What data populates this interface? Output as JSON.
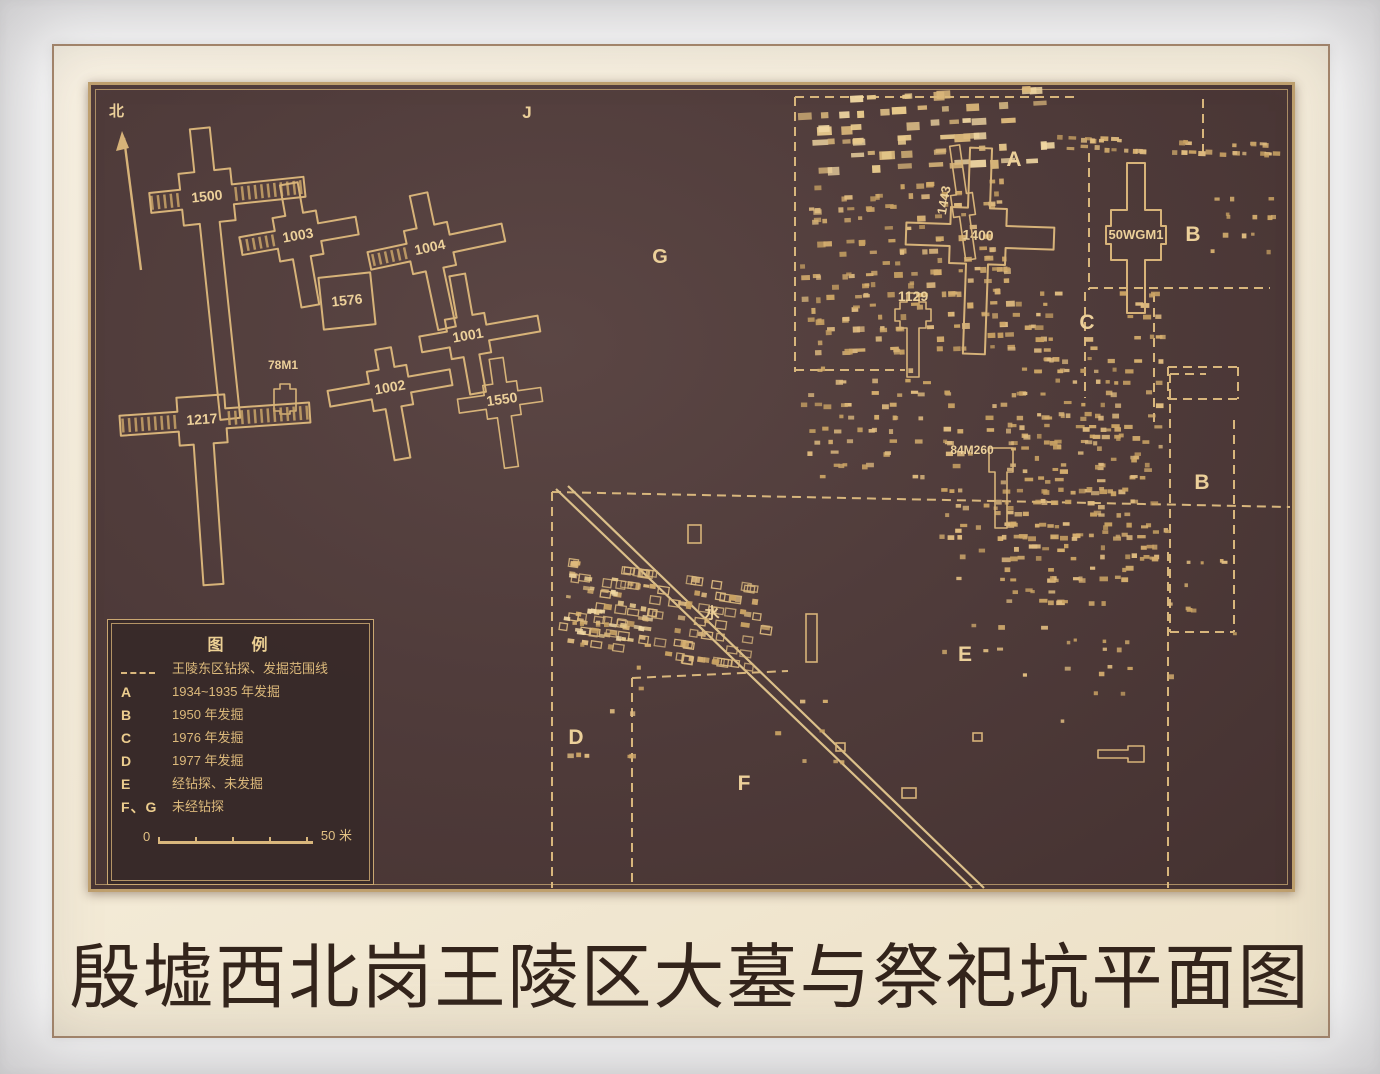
{
  "caption": "殷墟西北岗王陵区大墓与祭祀坑平面图",
  "compass": {
    "label": "北"
  },
  "legend": {
    "title": "图　例",
    "items": [
      {
        "symbol": "dash-line",
        "label": "王陵东区钻探、发掘范围线"
      },
      {
        "symbol": "A",
        "label": "1934~1935 年发掘"
      },
      {
        "symbol": "B",
        "label": "1950 年发掘"
      },
      {
        "symbol": "C",
        "label": "1976 年发掘"
      },
      {
        "symbol": "D",
        "label": "1977 年发掘"
      },
      {
        "symbol": "E",
        "label": "经钻探、未发掘"
      },
      {
        "symbol": "F、G",
        "label": "未经钻探"
      }
    ],
    "scale": {
      "start": "0",
      "end": "50 米"
    }
  },
  "map": {
    "colors": {
      "line": "#d7b379",
      "dash": "#d8b67c",
      "label": "#ecd09a",
      "pitMid": [
        "#d5ae6e",
        "#c9a263",
        "#e0bc80"
      ],
      "pitBright": [
        "#f0d7a2",
        "#e7c98c",
        "#dcb97b"
      ],
      "road": "#dcc08a",
      "hatch": "#c9a468"
    },
    "tombs": [
      {
        "id": "1500",
        "cx": 207,
        "cy": 197,
        "c": 26,
        "h": 10,
        "n": 69,
        "e": 98,
        "s": 223,
        "w": 57,
        "rot": -6,
        "hatch": [
          "e",
          "w"
        ]
      },
      {
        "id": "1003",
        "cx": 298,
        "cy": 236,
        "c": 22,
        "h": 9,
        "n": 53,
        "e": 60,
        "s": 71,
        "w": 58,
        "rot": -10,
        "hatch": [
          "w"
        ]
      },
      {
        "id": "1004",
        "cx": 430,
        "cy": 248,
        "c": 22,
        "h": 9,
        "n": 55,
        "e": 75,
        "s": 82,
        "w": 62,
        "rot": -12,
        "hatch": [
          "w"
        ]
      },
      {
        "id": "1576",
        "cx": 347,
        "cy": 301,
        "c": 26,
        "h": 0,
        "n": 0,
        "e": 0,
        "s": 0,
        "w": 0,
        "rot": -6,
        "square": true
      },
      {
        "id": "1001",
        "cx": 468,
        "cy": 336,
        "c": 20,
        "h": 8,
        "n": 62,
        "e": 72,
        "s": 58,
        "w": 48,
        "rot": -10
      },
      {
        "id": "1002",
        "cx": 390,
        "cy": 388,
        "c": 20,
        "h": 8,
        "n": 40,
        "e": 62,
        "s": 72,
        "w": 62,
        "rot": -10
      },
      {
        "id": "1550",
        "cx": 502,
        "cy": 400,
        "c": 17,
        "h": 7,
        "n": 42,
        "e": 40,
        "s": 68,
        "w": 44,
        "rot": -8
      },
      {
        "id": "78M1",
        "cx": 285,
        "cy": 400,
        "c": 11,
        "h": 5,
        "n": 16,
        "e": 0,
        "s": 14,
        "w": 0,
        "rot": 0,
        "ldx": -2,
        "ldy": -31,
        "fs": 12
      },
      {
        "id": "1217",
        "cx": 202,
        "cy": 420,
        "c": 24,
        "h": 10,
        "n": 0,
        "e": 108,
        "s": 165,
        "w": 82,
        "rot": -4,
        "hatch": [
          "e",
          "w"
        ]
      },
      {
        "id": "1400",
        "cx": 978,
        "cy": 236,
        "c": 28,
        "h": 11,
        "n": 88,
        "e": 76,
        "s": 118,
        "w": 72,
        "rot": 2
      },
      {
        "id": "1443",
        "cx": 963,
        "cy": 205,
        "c": 11,
        "h": 5,
        "n": 60,
        "e": 0,
        "s": 55,
        "w": 0,
        "rot": -8,
        "ldx": -14,
        "ldy": -6,
        "lrot": -72,
        "fs": 13
      },
      {
        "id": "1129",
        "cx": 913,
        "cy": 315,
        "c": 13,
        "h": 6,
        "n": 22,
        "e": 18,
        "s": 62,
        "w": 18,
        "rot": 0,
        "ldy": -14
      },
      {
        "id": "50WGM1",
        "cx": 1136,
        "cy": 235,
        "c": 25,
        "h": 9,
        "n": 72,
        "e": 30,
        "s": 78,
        "w": 30,
        "rot": 0,
        "fs": 13
      },
      {
        "id": "84M260",
        "cx": 1001,
        "cy": 460,
        "c": 12,
        "h": 6,
        "n": 0,
        "e": 0,
        "s": 68,
        "w": 0,
        "rot": 0,
        "ldx": -29,
        "ldy": -6,
        "fs": 12
      },
      {
        "id": "",
        "cx": 1136,
        "cy": 754,
        "c": 8,
        "h": 4,
        "n": 0,
        "e": 0,
        "s": 0,
        "w": 38,
        "rot": 0
      }
    ],
    "region_labels": [
      {
        "t": "J",
        "x": 527,
        "y": 118,
        "s": 17
      },
      {
        "t": "G",
        "x": 660,
        "y": 263,
        "s": 20
      },
      {
        "t": "A",
        "x": 1014,
        "y": 166,
        "s": 21
      },
      {
        "t": "B",
        "x": 1193,
        "y": 241,
        "s": 21
      },
      {
        "t": "C",
        "x": 1087,
        "y": 329,
        "s": 21
      },
      {
        "t": "B",
        "x": 1202,
        "y": 489,
        "s": 21
      },
      {
        "t": "E",
        "x": 965,
        "y": 661,
        "s": 21
      },
      {
        "t": "D",
        "x": 576,
        "y": 744,
        "s": 21
      },
      {
        "t": "F",
        "x": 744,
        "y": 790,
        "s": 21
      },
      {
        "t": "水",
        "x": 712,
        "y": 618,
        "s": 15
      }
    ],
    "dashed_lines": [
      [
        795,
        97,
        1075,
        97
      ],
      [
        795,
        97,
        795,
        372
      ],
      [
        795,
        370,
        905,
        370
      ],
      [
        1203,
        99,
        1203,
        158
      ],
      [
        1089,
        153,
        1089,
        290
      ],
      [
        1089,
        288,
        1270,
        288
      ],
      [
        1085,
        292,
        1085,
        398
      ],
      [
        1154,
        293,
        1154,
        428
      ],
      [
        1168,
        367,
        1238,
        367
      ],
      [
        1168,
        399,
        1238,
        399
      ],
      [
        1168,
        367,
        1168,
        399
      ],
      [
        1238,
        367,
        1238,
        399
      ],
      [
        552,
        492,
        1290,
        507
      ],
      [
        552,
        492,
        552,
        888
      ],
      [
        632,
        678,
        788,
        671
      ],
      [
        632,
        678,
        632,
        888
      ],
      [
        1168,
        552,
        1168,
        888
      ],
      [
        1170,
        374,
        1170,
        632
      ],
      [
        1234,
        420,
        1234,
        632
      ],
      [
        1170,
        632,
        1234,
        632
      ],
      [
        1170,
        374,
        1206,
        374
      ]
    ],
    "roads": [
      [
        556,
        489,
        972,
        888
      ],
      [
        568,
        486,
        984,
        888
      ]
    ],
    "compass": {
      "x1": 141,
      "y1": 270,
      "x2": 124,
      "y2": 138,
      "head": [
        [
          122,
          131
        ],
        [
          116,
          151
        ],
        [
          129,
          148
        ]
      ],
      "lx": 109,
      "ly": 116
    },
    "pit_clusters": [
      {
        "x": 798,
        "y": 93,
        "w": 250,
        "h": 90,
        "n": 64,
        "minW": 6,
        "maxW": 16,
        "minH": 4,
        "maxH": 9,
        "rowH": 14,
        "tilt": -3,
        "style": "bright",
        "seed": 1
      },
      {
        "x": 800,
        "y": 183,
        "w": 205,
        "h": 185,
        "n": 175,
        "minW": 4,
        "maxW": 9,
        "minH": 3,
        "maxH": 6,
        "rowH": 11,
        "tilt": -2,
        "style": "mid",
        "seed": 2
      },
      {
        "x": 793,
        "y": 368,
        "w": 160,
        "h": 125,
        "n": 55,
        "minW": 4,
        "maxW": 8,
        "minH": 3,
        "maxH": 5,
        "rowH": 12,
        "tilt": 0,
        "style": "mid",
        "seed": 3
      },
      {
        "x": 1000,
        "y": 292,
        "w": 160,
        "h": 325,
        "n": 195,
        "minW": 4,
        "maxW": 9,
        "minH": 3,
        "maxH": 5,
        "rowH": 11,
        "tilt": 0,
        "style": "mid",
        "seed": 4
      },
      {
        "x": 938,
        "y": 392,
        "w": 215,
        "h": 175,
        "n": 95,
        "minW": 4,
        "maxW": 8,
        "minH": 3,
        "maxH": 5,
        "rowH": 12,
        "tilt": 0,
        "style": "mid",
        "seed": 5
      },
      {
        "x": 1048,
        "y": 140,
        "w": 235,
        "h": 26,
        "n": 42,
        "minW": 4,
        "maxW": 8,
        "minH": 3,
        "maxH": 5,
        "rowH": 9,
        "tilt": 2,
        "style": "mid",
        "seed": 6
      },
      {
        "x": 560,
        "y": 573,
        "w": 205,
        "h": 92,
        "n": 118,
        "minW": 5,
        "maxW": 9,
        "minH": 4,
        "maxH": 6,
        "rowH": 13,
        "tilt": 8,
        "style": "ring",
        "seed": 7
      },
      {
        "x": 563,
        "y": 578,
        "w": 85,
        "h": 70,
        "n": 40,
        "minW": 4,
        "maxW": 8,
        "minH": 3,
        "maxH": 5,
        "rowH": 11,
        "tilt": 8,
        "style": "bright",
        "seed": 14
      },
      {
        "x": 556,
        "y": 622,
        "w": 95,
        "h": 160,
        "n": 16,
        "minW": 4,
        "maxW": 7,
        "minH": 3,
        "maxH": 5,
        "rowH": 22,
        "tilt": 0,
        "style": "mid",
        "seed": 8
      },
      {
        "x": 930,
        "y": 505,
        "w": 245,
        "h": 215,
        "n": 34,
        "minW": 4,
        "maxW": 7,
        "minH": 3,
        "maxH": 5,
        "rowH": 24,
        "tilt": 0,
        "style": "mid",
        "seed": 9
      },
      {
        "x": 1205,
        "y": 196,
        "w": 75,
        "h": 85,
        "n": 13,
        "minW": 3,
        "maxW": 6,
        "minH": 3,
        "maxH": 5,
        "rowH": 18,
        "tilt": 0,
        "style": "mid",
        "seed": 10
      },
      {
        "x": 1180,
        "y": 560,
        "w": 58,
        "h": 115,
        "n": 9,
        "minW": 3,
        "maxW": 6,
        "minH": 3,
        "maxH": 4,
        "rowH": 24,
        "tilt": 0,
        "style": "mid",
        "seed": 11
      },
      {
        "x": 735,
        "y": 700,
        "w": 130,
        "h": 105,
        "n": 7,
        "minW": 4,
        "maxW": 7,
        "minH": 3,
        "maxH": 5,
        "rowH": 30,
        "tilt": 0,
        "style": "mid",
        "seed": 12
      },
      {
        "x": 1060,
        "y": 640,
        "w": 80,
        "h": 120,
        "n": 10,
        "minW": 3,
        "maxW": 6,
        "minH": 3,
        "maxH": 4,
        "rowH": 26,
        "tilt": 0,
        "style": "mid",
        "seed": 13
      }
    ],
    "extras": [
      {
        "x": 688,
        "y": 525,
        "w": 13,
        "h": 18
      },
      {
        "x": 806,
        "y": 614,
        "w": 11,
        "h": 48
      },
      {
        "x": 836,
        "y": 743,
        "w": 9,
        "h": 8
      },
      {
        "x": 973,
        "y": 733,
        "w": 9,
        "h": 8
      },
      {
        "x": 902,
        "y": 788,
        "w": 14,
        "h": 10
      }
    ]
  }
}
